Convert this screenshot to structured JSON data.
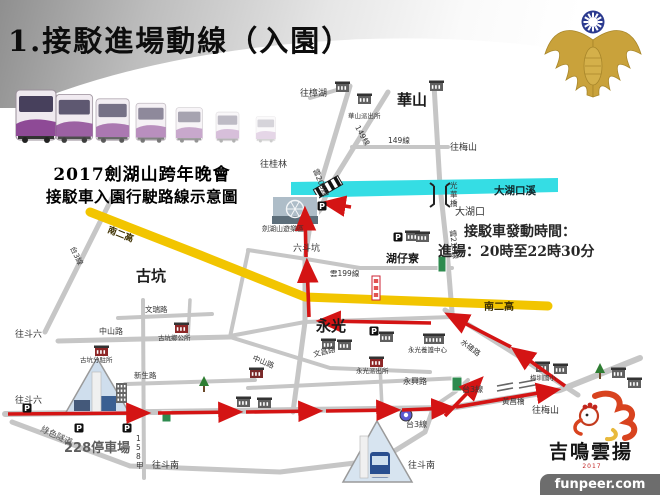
{
  "slide": {
    "title": "1.接駁進場動線（入園）"
  },
  "legend": {
    "line1": "2017劍湖山跨年晚會",
    "line2": "接駁車入園行駛路線示意圖"
  },
  "schedule": {
    "line1": "接駁車發動時間：",
    "line2": "進場：20時至22時30分"
  },
  "logo": {
    "text": "吉鳴雲揚",
    "sub": "2017"
  },
  "watermark": {
    "text": "funpeer.com"
  },
  "map": {
    "colors": {
      "road": "#c6c6c6",
      "highway": "#f2c500",
      "river": "#35dde4",
      "route": "#d41414"
    },
    "highway": {
      "name": "南二高",
      "p": "90,212 200,255 305,297 548,306"
    },
    "river": {
      "name": "大湖口溪",
      "p": "291,182 558,178 558,192 291,198"
    },
    "roads": [
      {
        "p": "112,198 45,332",
        "w": 5
      },
      {
        "p": "350,86 312,212 305,258 305,322 297,382 293,412",
        "w": 5
      },
      {
        "p": "388,92 330,186 320,210 313,218",
        "w": 5
      },
      {
        "p": "352,147 448,147",
        "w": 4
      },
      {
        "p": "434,85 440,186 447,250 452,312",
        "w": 5
      },
      {
        "p": "248,250 300,258 360,268 452,268",
        "w": 4
      },
      {
        "p": "230,336 305,322 452,317",
        "w": 4
      },
      {
        "p": "445,310 520,357 578,395",
        "w": 5
      },
      {
        "p": "5,414 450,408 560,390 640,358",
        "w": 6
      },
      {
        "p": "58,341 230,337",
        "w": 5
      },
      {
        "p": "230,337 330,368 430,372",
        "w": 4
      },
      {
        "p": "125,384 255,380",
        "w": 4
      },
      {
        "p": "143,300 144,478",
        "w": 4
      },
      {
        "p": "118,318 212,314",
        "w": 4
      },
      {
        "p": "190,300 188,338",
        "w": 3.5
      },
      {
        "p": "12,422 130,466 280,472 380,460 425,432 432,412",
        "w": 5
      },
      {
        "p": "380,365 382,408",
        "w": 3.5
      },
      {
        "p": "248,388 460,378",
        "w": 4
      },
      {
        "p": "350,86 310,98",
        "w": 4
      },
      {
        "p": "230,337 240,290 248,252",
        "w": 4
      },
      {
        "p": "430,409 455,392 468,380",
        "w": 4
      }
    ],
    "arrows": [
      "8,414 146,413",
      "158,413 238,412",
      "246,412 318,411",
      "326,411 396,410",
      "402,410 451,408",
      "456,407 556,390",
      "445,416 480,380",
      "565,386 515,350",
      "511,347 449,315",
      "431,323 321,321",
      "309,317 307,263",
      "306,257 305,211",
      "351,207 326,203"
    ],
    "parking": [
      [
        322,
        206
      ],
      [
        398,
        237
      ],
      [
        374,
        331
      ],
      [
        27,
        408
      ],
      [
        79,
        428
      ],
      [
        127,
        428
      ]
    ],
    "signs": {
      "green": [
        [
          452,
          377,
          10,
          14
        ],
        [
          438,
          256,
          8,
          16
        ],
        [
          162,
          411,
          9,
          11
        ]
      ],
      "white": [
        372,
        276,
        8,
        24
      ],
      "blue_marker": [
        406,
        415
      ]
    },
    "bridges": {
      "double": [
        [
          497,
          386,
          513,
          383
        ],
        [
          497,
          391,
          513,
          388
        ],
        [
          519,
          383,
          535,
          380
        ],
        [
          519,
          388,
          535,
          385
        ]
      ]
    },
    "photos": {
      "jfs": {
        "x": 272,
        "y": 196,
        "w": 46,
        "h": 28
      },
      "tri1": "97,358 65,414 130,414",
      "tri2": "377,421 343,482 412,482"
    },
    "buildings": [
      {
        "x": 358,
        "y": 96,
        "t": "b"
      },
      {
        "x": 336,
        "y": 84,
        "t": "b"
      },
      {
        "x": 430,
        "y": 83,
        "t": "b"
      },
      {
        "x": 406,
        "y": 233,
        "t": "b"
      },
      {
        "x": 416,
        "y": 234,
        "t": "b"
      },
      {
        "x": 380,
        "y": 334,
        "t": "b"
      },
      {
        "x": 322,
        "y": 341,
        "t": "b"
      },
      {
        "x": 338,
        "y": 342,
        "t": "b"
      },
      {
        "x": 370,
        "y": 359,
        "t": "r"
      },
      {
        "x": 424,
        "y": 336,
        "t": "b2"
      },
      {
        "x": 175,
        "y": 325,
        "t": "r"
      },
      {
        "x": 95,
        "y": 348,
        "t": "r"
      },
      {
        "x": 250,
        "y": 370,
        "t": "t"
      },
      {
        "x": 116,
        "y": 383,
        "t": "tall"
      },
      {
        "x": 536,
        "y": 364,
        "t": "b"
      },
      {
        "x": 554,
        "y": 366,
        "t": "b"
      },
      {
        "x": 612,
        "y": 370,
        "t": "b"
      },
      {
        "x": 628,
        "y": 380,
        "t": "b"
      },
      {
        "x": 237,
        "y": 399,
        "t": "b"
      },
      {
        "x": 258,
        "y": 400,
        "t": "b"
      }
    ],
    "trees": [
      [
        204,
        384
      ],
      [
        600,
        371
      ]
    ],
    "labels": [
      {
        "t": "華山",
        "x": 397,
        "y": 105,
        "s": 15,
        "w": 1,
        "c": "#1a1a1a",
        "n": "area-huashan"
      },
      {
        "t": "古坑",
        "x": 136,
        "y": 281,
        "s": 15,
        "w": 1,
        "c": "#1a1a1a",
        "n": "area-gukeng"
      },
      {
        "t": "永光",
        "x": 316,
        "y": 331,
        "s": 15,
        "w": 1,
        "c": "#1a1a1a",
        "n": "area-yongguang"
      },
      {
        "t": "湖仔寮",
        "x": 386,
        "y": 262,
        "s": 11,
        "w": 1,
        "c": "#1a1a1a",
        "n": "area-huzailiao"
      },
      {
        "t": "大湖口",
        "x": 455,
        "y": 215,
        "s": 10,
        "n": "area-dahukou"
      },
      {
        "t": "六斗坑",
        "x": 293,
        "y": 251,
        "s": 9,
        "n": "area-liudoukeng"
      },
      {
        "t": "往樟湖",
        "x": 300,
        "y": 96,
        "s": 9,
        "n": "dir-zhanghu"
      },
      {
        "t": "往桂林",
        "x": 260,
        "y": 167,
        "s": 9,
        "n": "dir-guilin"
      },
      {
        "t": "往梅山",
        "x": 450,
        "y": 150,
        "s": 9,
        "n": "dir-meishan-north"
      },
      {
        "t": "往梅山",
        "x": 532,
        "y": 413,
        "s": 9,
        "n": "dir-meishan-south"
      },
      {
        "t": "往斗六",
        "x": 15,
        "y": 337,
        "s": 9,
        "n": "dir-douliu-1"
      },
      {
        "t": "往斗六",
        "x": 15,
        "y": 403,
        "s": 9,
        "n": "dir-douliu-2"
      },
      {
        "t": "往斗南",
        "x": 152,
        "y": 468,
        "s": 9,
        "n": "dir-dounan-1"
      },
      {
        "t": "往斗南",
        "x": 408,
        "y": 468,
        "s": 9,
        "n": "dir-dounan-2"
      },
      {
        "t": "149線",
        "x": 355,
        "y": 127,
        "s": 7.5,
        "r": 62
      },
      {
        "t": "149線",
        "x": 388,
        "y": 143,
        "s": 7.5
      },
      {
        "t": "雲209線",
        "x": 313,
        "y": 170,
        "s": 7.5,
        "r": 68
      },
      {
        "t": "雲210線",
        "x": 450,
        "y": 230,
        "s": 7.5,
        "r": 84
      },
      {
        "t": "雲199線",
        "x": 330,
        "y": 276,
        "s": 7.5
      },
      {
        "t": "台3線",
        "x": 70,
        "y": 248,
        "s": 7.5,
        "r": 64
      },
      {
        "t": "台3線",
        "x": 462,
        "y": 392,
        "s": 8
      },
      {
        "t": "台3線",
        "x": 406,
        "y": 427,
        "s": 8
      },
      {
        "t": "水碓路",
        "x": 460,
        "y": 343,
        "s": 7.5,
        "r": 37
      },
      {
        "t": "文昌路",
        "x": 314,
        "y": 357,
        "s": 7.5,
        "r": -14
      },
      {
        "t": "永興路",
        "x": 403,
        "y": 384,
        "s": 8
      },
      {
        "t": "中山路",
        "x": 99,
        "y": 334,
        "s": 8
      },
      {
        "t": "中山路",
        "x": 252,
        "y": 360,
        "s": 7.5,
        "r": 22
      },
      {
        "t": "新生路",
        "x": 134,
        "y": 378,
        "s": 7.5
      },
      {
        "t": "文瑞路",
        "x": 145,
        "y": 312,
        "s": 7.5
      },
      {
        "t": "158甲",
        "x": 136,
        "y": 441,
        "s": 7.5,
        "v": 1
      },
      {
        "t": "南二高",
        "x": 107,
        "y": 232,
        "s": 9,
        "r": 22,
        "w": 1,
        "c": "#3d3000"
      },
      {
        "t": "南二高",
        "x": 484,
        "y": 310,
        "s": 10,
        "w": 1,
        "c": "#3d3000"
      },
      {
        "t": "綠色隧道",
        "x": 40,
        "y": 431,
        "s": 8.5,
        "r": 25,
        "c": "#555"
      },
      {
        "t": "光華橋",
        "x": 450,
        "y": 188,
        "s": 7.5,
        "v": 1,
        "n": "bridge-guanghua-label"
      },
      {
        "t": "黃昌橋",
        "x": 502,
        "y": 404,
        "s": 7.5,
        "n": "bridge-huangchang-label"
      },
      {
        "t": "劍湖山遊樂區",
        "x": 262,
        "y": 231,
        "s": 7,
        "n": "janfusan-label"
      },
      {
        "t": "華山派出所",
        "x": 348,
        "y": 118,
        "s": 6.5
      },
      {
        "t": "古坑鄉公所",
        "x": 158,
        "y": 340,
        "s": 6.5
      },
      {
        "t": "古坑分駐所",
        "x": 80,
        "y": 362,
        "s": 6.5
      },
      {
        "t": "永光派出所",
        "x": 356,
        "y": 373,
        "s": 6.5
      },
      {
        "t": "永光養護中心",
        "x": 408,
        "y": 352,
        "s": 6.5
      },
      {
        "t": "梅圳國小",
        "x": 530,
        "y": 380,
        "s": 6.5
      },
      {
        "t": "228停車場",
        "x": 64,
        "y": 452,
        "s": 13,
        "w": 1,
        "c": "#5e5e5e",
        "n": "parking-228-label"
      },
      {
        "t": "大湖口溪",
        "x": 494,
        "y": 194,
        "s": 10.5,
        "w": 1,
        "c": "#10262a",
        "n": "river-label"
      }
    ]
  }
}
